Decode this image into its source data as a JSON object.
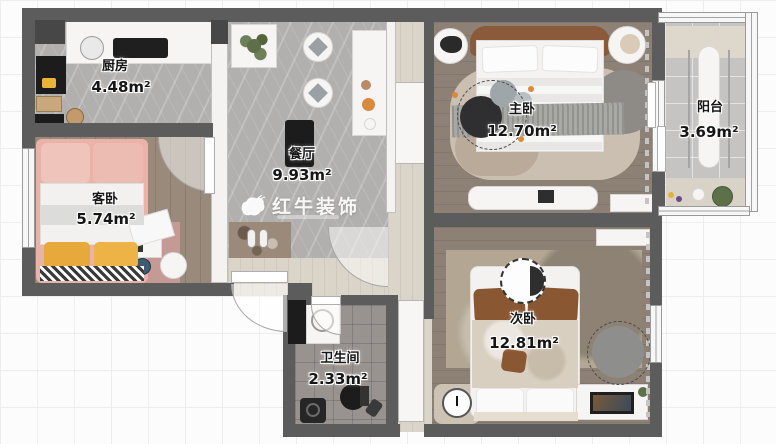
{
  "plan": {
    "watermark_brand": "红牛装饰",
    "rooms": {
      "kitchen": {
        "name": "厨房",
        "area": "4.48m²"
      },
      "dining": {
        "name": "餐厅",
        "area": "9.93m²"
      },
      "guest_bedroom": {
        "name": "客卧",
        "area": "5.74m²"
      },
      "master_bedroom": {
        "name": "主卧",
        "area": "12.70m²"
      },
      "balcony": {
        "name": "阳台",
        "area": "3.69m²"
      },
      "second_bedroom": {
        "name": "次卧",
        "area": "12.81m²"
      },
      "bathroom": {
        "name": "卫生间",
        "area": "2.33m²"
      }
    },
    "colors": {
      "wall": "#5c5c5c",
      "marble_floor": "#b2b0ae",
      "wood_floor": "#8d8176",
      "tile_floor": "#99938f",
      "accent_pink": "#e9b3a9",
      "accent_brown": "#8a5a3b",
      "accent_yellow": "#e8a93c",
      "watermark_white": "#ffffff"
    }
  }
}
